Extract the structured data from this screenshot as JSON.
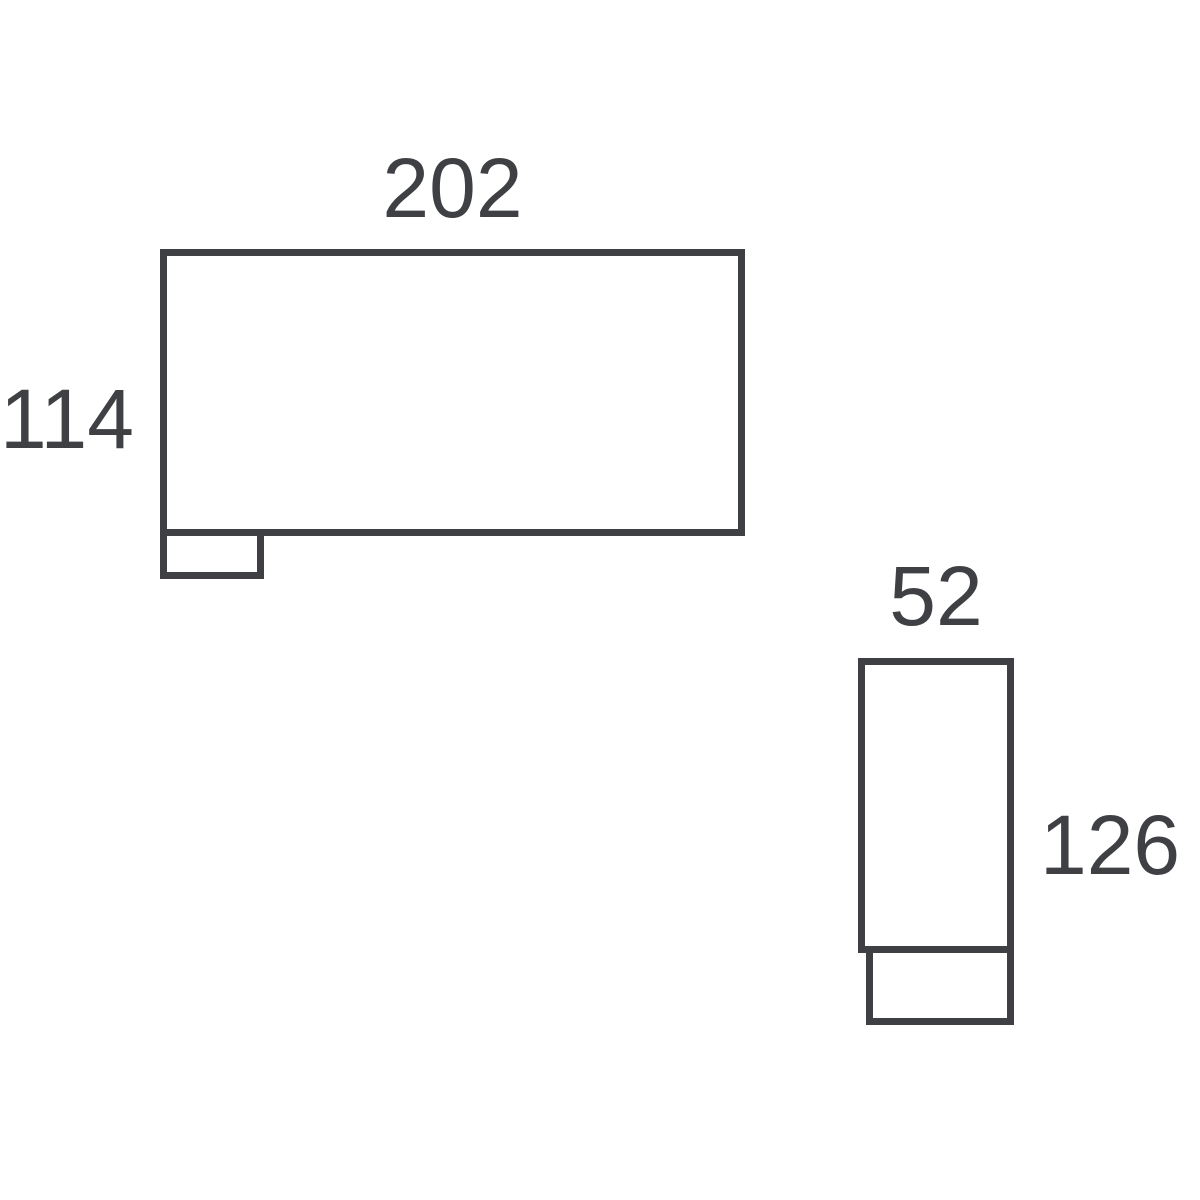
{
  "diagram": {
    "type": "furniture-dimension-plan",
    "background_color": "#ffffff",
    "stroke_color": "#3e4044",
    "text_color": "#3e4044",
    "modules": [
      {
        "id": "module-a",
        "width_label": "202",
        "height_label": "114",
        "width_value": 202,
        "height_value": 114,
        "foot": "bottom-left"
      },
      {
        "id": "module-b",
        "width_label": "52",
        "height_label": "126",
        "width_value": 52,
        "height_value": 126,
        "foot": "bottom"
      }
    ]
  }
}
